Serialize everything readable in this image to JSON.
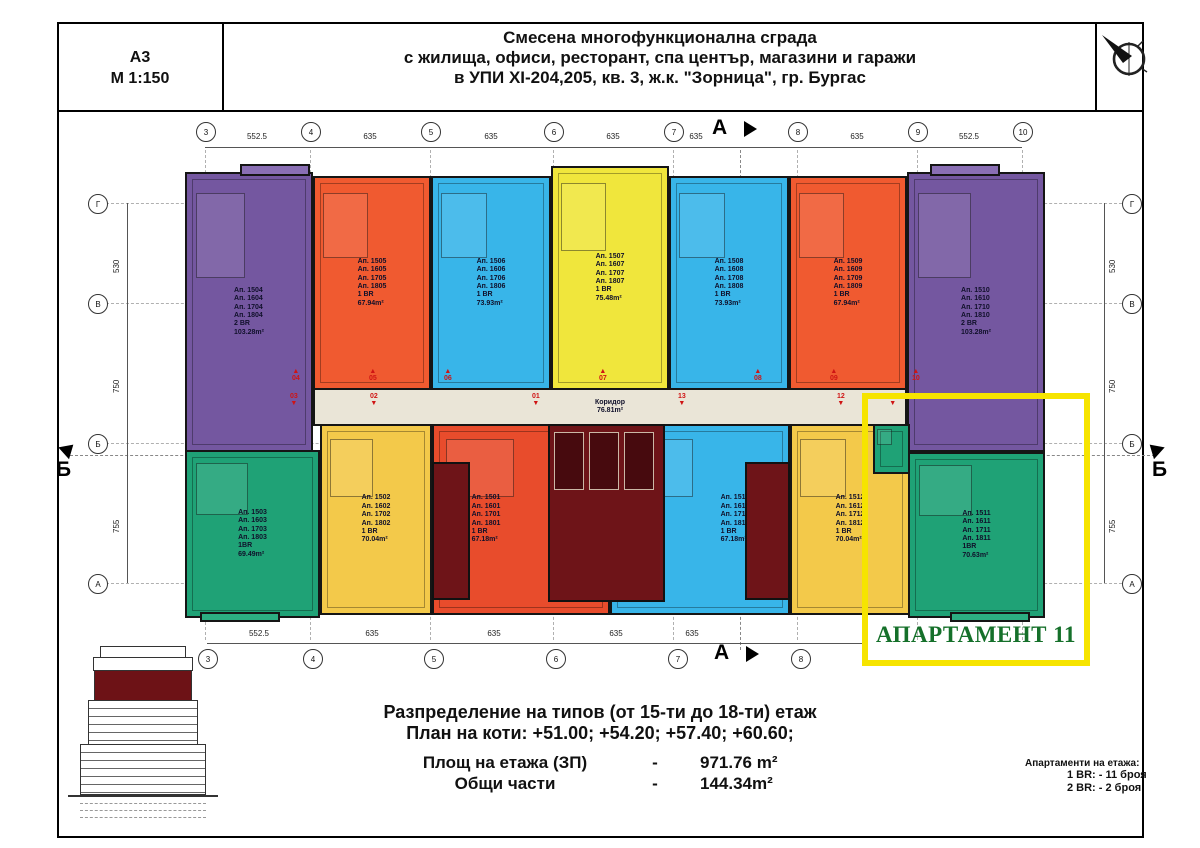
{
  "sheet": {
    "format": "А3",
    "scale": "М 1:150"
  },
  "title": {
    "line1": "Смесена многофункционална сграда",
    "line2": "с жилища, офиси, ресторант, спа център, магазини и  гаражи",
    "line3": "в УПИ XI-204,205, кв. 3, ж.к. \"Зорница\", гр. Бургас"
  },
  "grid": {
    "top_cols": [
      "3",
      "4",
      "5",
      "6",
      "7",
      "8",
      "9",
      "10"
    ],
    "bottom_cols": [
      "3",
      "4",
      "5",
      "6",
      "7",
      "8"
    ],
    "top_dims": [
      "552.5",
      "635",
      "635",
      "635",
      "635",
      "635",
      "552.5"
    ],
    "bottom_dims": [
      "552.5",
      "635",
      "635",
      "635",
      "635"
    ],
    "rows": [
      "Г",
      "В",
      "Б",
      "А"
    ],
    "row_dims": [
      "530",
      "750",
      "755"
    ],
    "section_a": "А",
    "section_b": "Б"
  },
  "plan": {
    "corridor": "Коридор\n76.81m²"
  },
  "apartments": [
    {
      "unit": "04",
      "text": "Ап. 1504\nАп. 1604\nАп. 1704\nАп. 1804\n2 BR\n103.28m²"
    },
    {
      "unit": "05",
      "text": "Ап. 1505\nАп. 1605\nАп. 1705\nАп. 1805\n1 BR\n67.94m²"
    },
    {
      "unit": "06",
      "text": "Ап. 1506\nАп. 1606\nАп. 1706\nАп. 1806\n1 BR\n73.93m²"
    },
    {
      "unit": "07",
      "text": "Ап. 1507\nАп. 1607\nАп. 1707\nАп. 1807\n1 BR\n75.48m²"
    },
    {
      "unit": "08",
      "text": "Ап. 1508\nАп. 1608\nАп. 1708\nАп. 1808\n1 BR\n73.93m²"
    },
    {
      "unit": "09",
      "text": "Ап. 1509\nАп. 1609\nАп. 1709\nАп. 1809\n1 BR\n67.94m²"
    },
    {
      "unit": "10",
      "text": "Ап. 1510\nАп. 1610\nАп. 1710\nАп. 1810\n2 BR\n103.28m²"
    },
    {
      "unit": "03",
      "text": "Ап. 1503\nАп. 1603\nАп. 1703\nАп. 1803\n1BR\n69.49m²"
    },
    {
      "unit": "02",
      "text": "Ап. 1502\nАп. 1602\nАп. 1702\nАп. 1802\n1 BR\n70.04m²"
    },
    {
      "unit": "01",
      "text": "Ап. 1501\nАп. 1601\nАп. 1701\nАп. 1801\n1 BR\n67.18m²"
    },
    {
      "unit": "13",
      "text": "Ап. 1513\nАп. 1613\nАп. 1713\nАп. 1813\n1 BR\n67.18m²"
    },
    {
      "unit": "12",
      "text": "Ап. 1512\nАп. 1612\nАп. 1712\nАп. 1812\n1 BR\n70.04m²"
    },
    {
      "unit": "11",
      "text": "Ап. 1511\nАп. 1611\nАп. 1711\nАп. 1811\n1BR\n70.63m²"
    }
  ],
  "unit_markers": {
    "top": [
      "04",
      "05",
      "06",
      "07",
      "08",
      "09",
      "10"
    ],
    "bottom": [
      "03",
      "02",
      "01",
      "13",
      "12",
      "11"
    ]
  },
  "highlight": {
    "label": "АПАРТАМЕНТ 11"
  },
  "notes": {
    "heading1": "Разпределение на типов  (от 15-ти до 18-ти) етаж",
    "heading2": "План на коти:  +51.00; +54.20; +57.40; +60.60;",
    "row1_label": "Площ на етажа (ЗП)",
    "row1_sep": "-",
    "row1_value": "971.76 m²",
    "row2_label": "Общи части",
    "row2_sep": "-",
    "row2_value": "144.34m²"
  },
  "legend": {
    "title": "Апартаменти на етажа:",
    "line1": "1 BR: - 11 броя",
    "line2": "2 BR: - 2  броя"
  },
  "palette": {
    "purple": "#7457a0",
    "orange": "#f05a30",
    "blue": "#38b5e9",
    "yellow": "#f0e63c",
    "gold": "#f3c94a",
    "green": "#1fa276",
    "red": "#e84c2c",
    "core": "#6e1418",
    "corridor": "#eae5d7",
    "highlight_border": "#f6e400",
    "highlight_text": "#15702a",
    "marker_red": "#cf1414"
  }
}
